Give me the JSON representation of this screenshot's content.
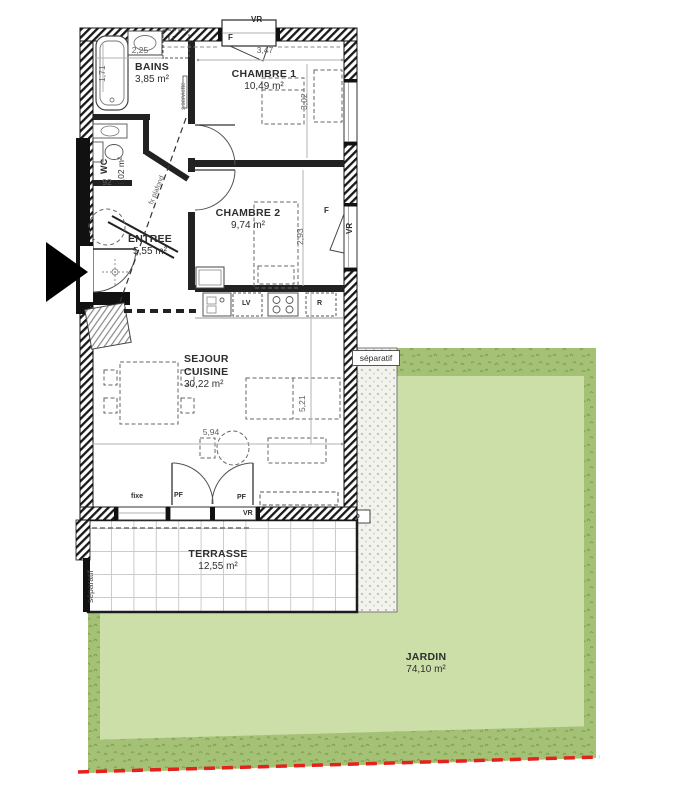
{
  "rooms": {
    "bains": {
      "name": "BAINS",
      "area": "3,85 m²"
    },
    "chambre1": {
      "name": "CHAMBRE 1",
      "area": "10,49 m²"
    },
    "wc": {
      "name": "WC",
      "area": "1,02 m²"
    },
    "chambre2": {
      "name": "CHAMBRE 2",
      "area": "9,74 m²"
    },
    "entree": {
      "name": "ENTREE",
      "area": "5,55 m²"
    },
    "sejour": {
      "name_line1": "SEJOUR",
      "name_line2": "CUISINE",
      "area": "30,22 m²"
    },
    "terrasse": {
      "name": "TERRASSE",
      "area": "12,55 m²"
    },
    "jardin": {
      "name": "JARDIN",
      "area": "74,10 m²"
    }
  },
  "dimensions": {
    "bains_width": "2,25",
    "bains_depth": "1,71",
    "chambre1_width": "3,47",
    "chambre1_depth": "3,02",
    "chambre2_depth": "2,93",
    "wc_width": "92",
    "sejour_width": "5,94",
    "sejour_depth": "5,21"
  },
  "annotations": {
    "vr": "VR",
    "f": "F",
    "pf": "PF",
    "fixe": "fixe",
    "ll": "LL",
    "lv": "LV",
    "r": "R",
    "separatif": "séparatif",
    "faux_plafond": "fx plafond",
    "seche_serviette": "s.serviette"
  },
  "colors": {
    "garden_light": "#ccdfa8",
    "garden_dark": "#a4c175",
    "boundary_red": "#e3221b",
    "wall": "#1a1a1a"
  }
}
